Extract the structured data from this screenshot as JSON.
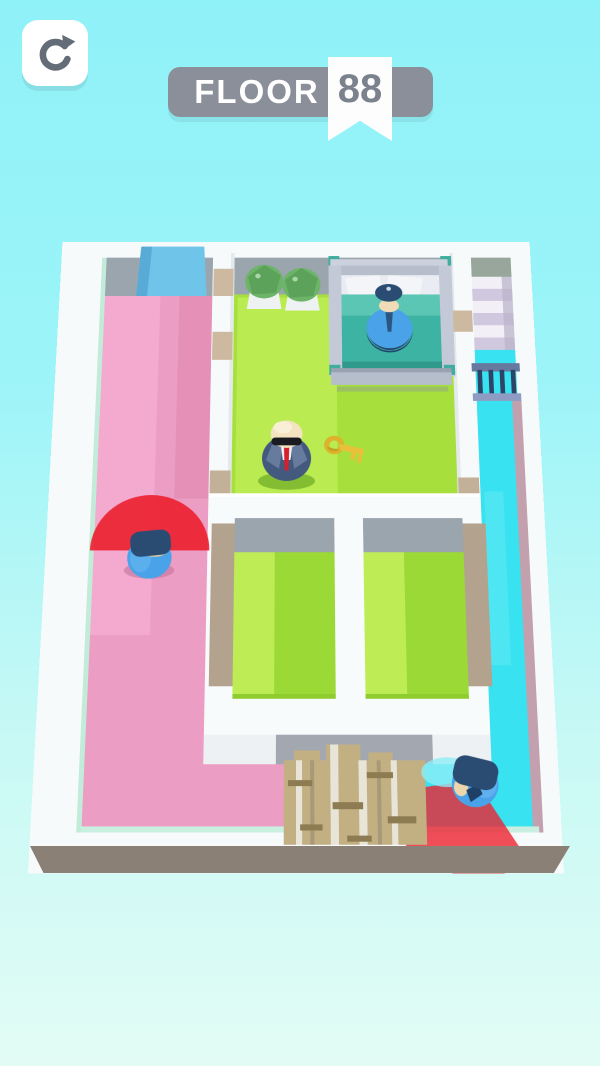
{
  "hud": {
    "floor_banner": {
      "label": "FLOOR",
      "number": "88"
    },
    "restart_icon": "circular-arrow-refresh"
  },
  "colors": {
    "bg_top": "#8ff2f8",
    "bg_bottom": "#e2fcf5",
    "hud_gray": "#8a8f9a",
    "ribbon_white": "#fdfdfe",
    "hud_text": "#ffffff",
    "floor_number_text": "#7c828d",
    "restart_icon": "#646c77",
    "button_white": "#ffffff",
    "wall_white": "#f7fafb",
    "wall_face_gray": "#9aa5ae",
    "mint_edge": "#c2ecd9",
    "skirt_taupe": "#8b8076",
    "floor_pink": "#ec9dc3",
    "floor_pink_light": "#f4accf",
    "floor_green": "#a7e03d",
    "floor_green_light": "#bdec55",
    "floor_green_dark": "#9bd936",
    "floor_cyan": "#38e2f1",
    "floor_cyan_light": "#66ebf5",
    "ramp_blue": "#6fc4ea",
    "tan_sill": "#cdb9a0",
    "tan_ledge": "#b3a28e",
    "mauve_wall": "#c3a0ad",
    "bed_frame": "#b6bdcb",
    "bed_blanket": "#3db3a3",
    "bed_blanket_light": "#5cc6b5",
    "bed_pillow": "#f4f5f9",
    "bed_knob": "#3fae9e",
    "bush_green": "#6cb468",
    "bush_green_dark": "#569a54",
    "plank_tan": "#c2b083",
    "plank_stripe": "#e8e4d8",
    "plank_seam": "#8d7c52",
    "vision_red": "#ec2331",
    "guard_blue": "#4aa2e8",
    "guard_cap": "#2b4c72",
    "skin": "#f0dcb6",
    "agent_suit": "#44597e",
    "agent_tie": "#d5202d",
    "agent_shirt": "#f2f4f7",
    "agent_skin": "#f3e3c0",
    "sunglasses": "#1a1b20",
    "key_gold": "#e7c13a",
    "stair_white": "#f2f0f6",
    "stair_lavender": "#cfc8de",
    "stair_landing": "#99a69b",
    "rail_top": "#68799f",
    "rail_post": "#2d4467",
    "rail_base": "#8e9cc4"
  },
  "scene": {
    "entities": [
      "player-agent",
      "gold-key",
      "sleeping-guard-in-bed",
      "patrol-guard-pink-corridor",
      "patrol-guard-cyan-corridor",
      "vision-cone-left",
      "vision-cone-right",
      "bed",
      "bush",
      "bush",
      "stairs",
      "railing",
      "wood-plank-pile",
      "blue-ramp"
    ]
  }
}
